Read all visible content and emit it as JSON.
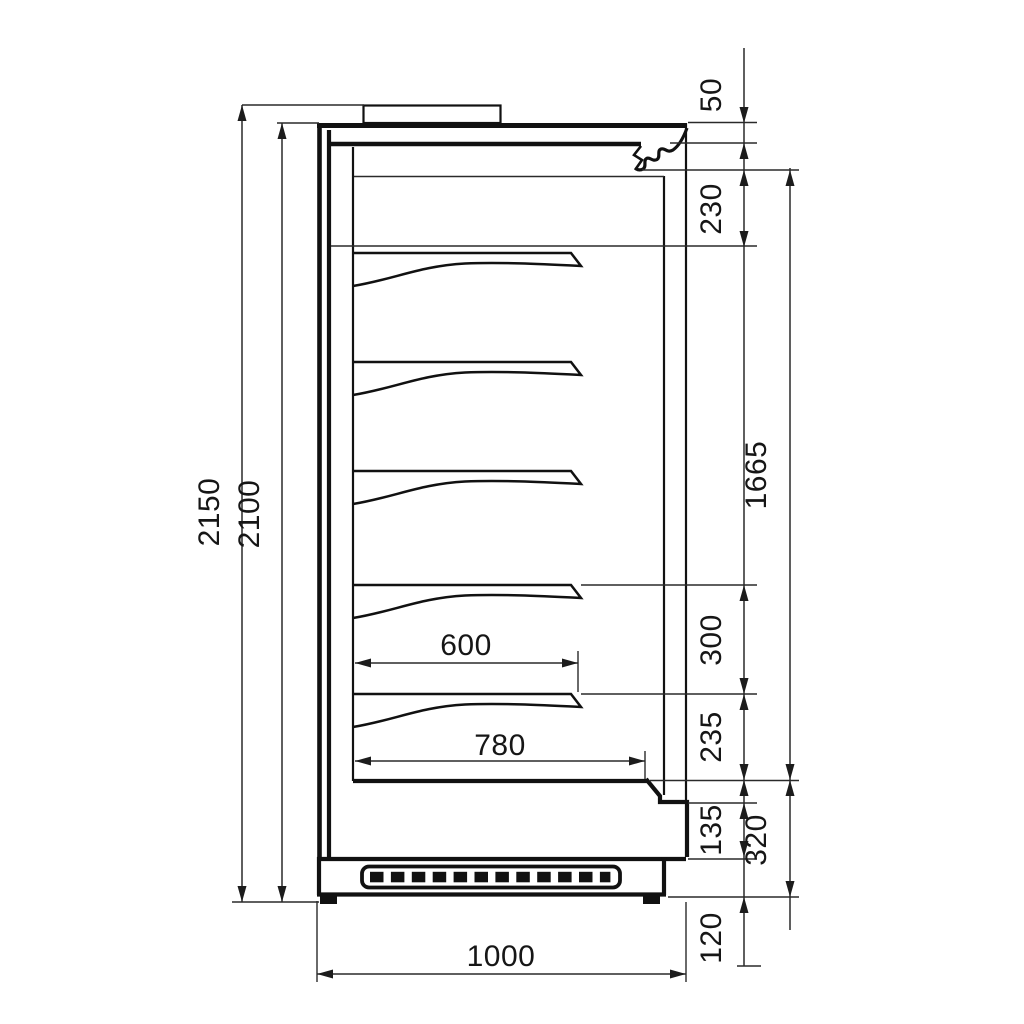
{
  "drawing": {
    "kind": "technical-section-drawing",
    "shelf_count": 5,
    "dimensions": {
      "d2150": "2150",
      "d2100": "2100",
      "d50": "50",
      "d230": "230",
      "d1665": "1665",
      "d300": "300",
      "d235": "235",
      "d135": "135",
      "d320": "320",
      "d120": "120",
      "d600": "600",
      "d780": "780",
      "d1000": "1000"
    },
    "vertical_dimensions_left": [
      "2150",
      "2100"
    ],
    "vertical_dimensions_right": [
      "50",
      "230",
      "1665",
      "300",
      "235",
      "135",
      "320",
      "120"
    ],
    "horizontal_dimensions": [
      "600",
      "780",
      "1000"
    ],
    "line_color": "#111111",
    "background_color": "#ffffff"
  }
}
